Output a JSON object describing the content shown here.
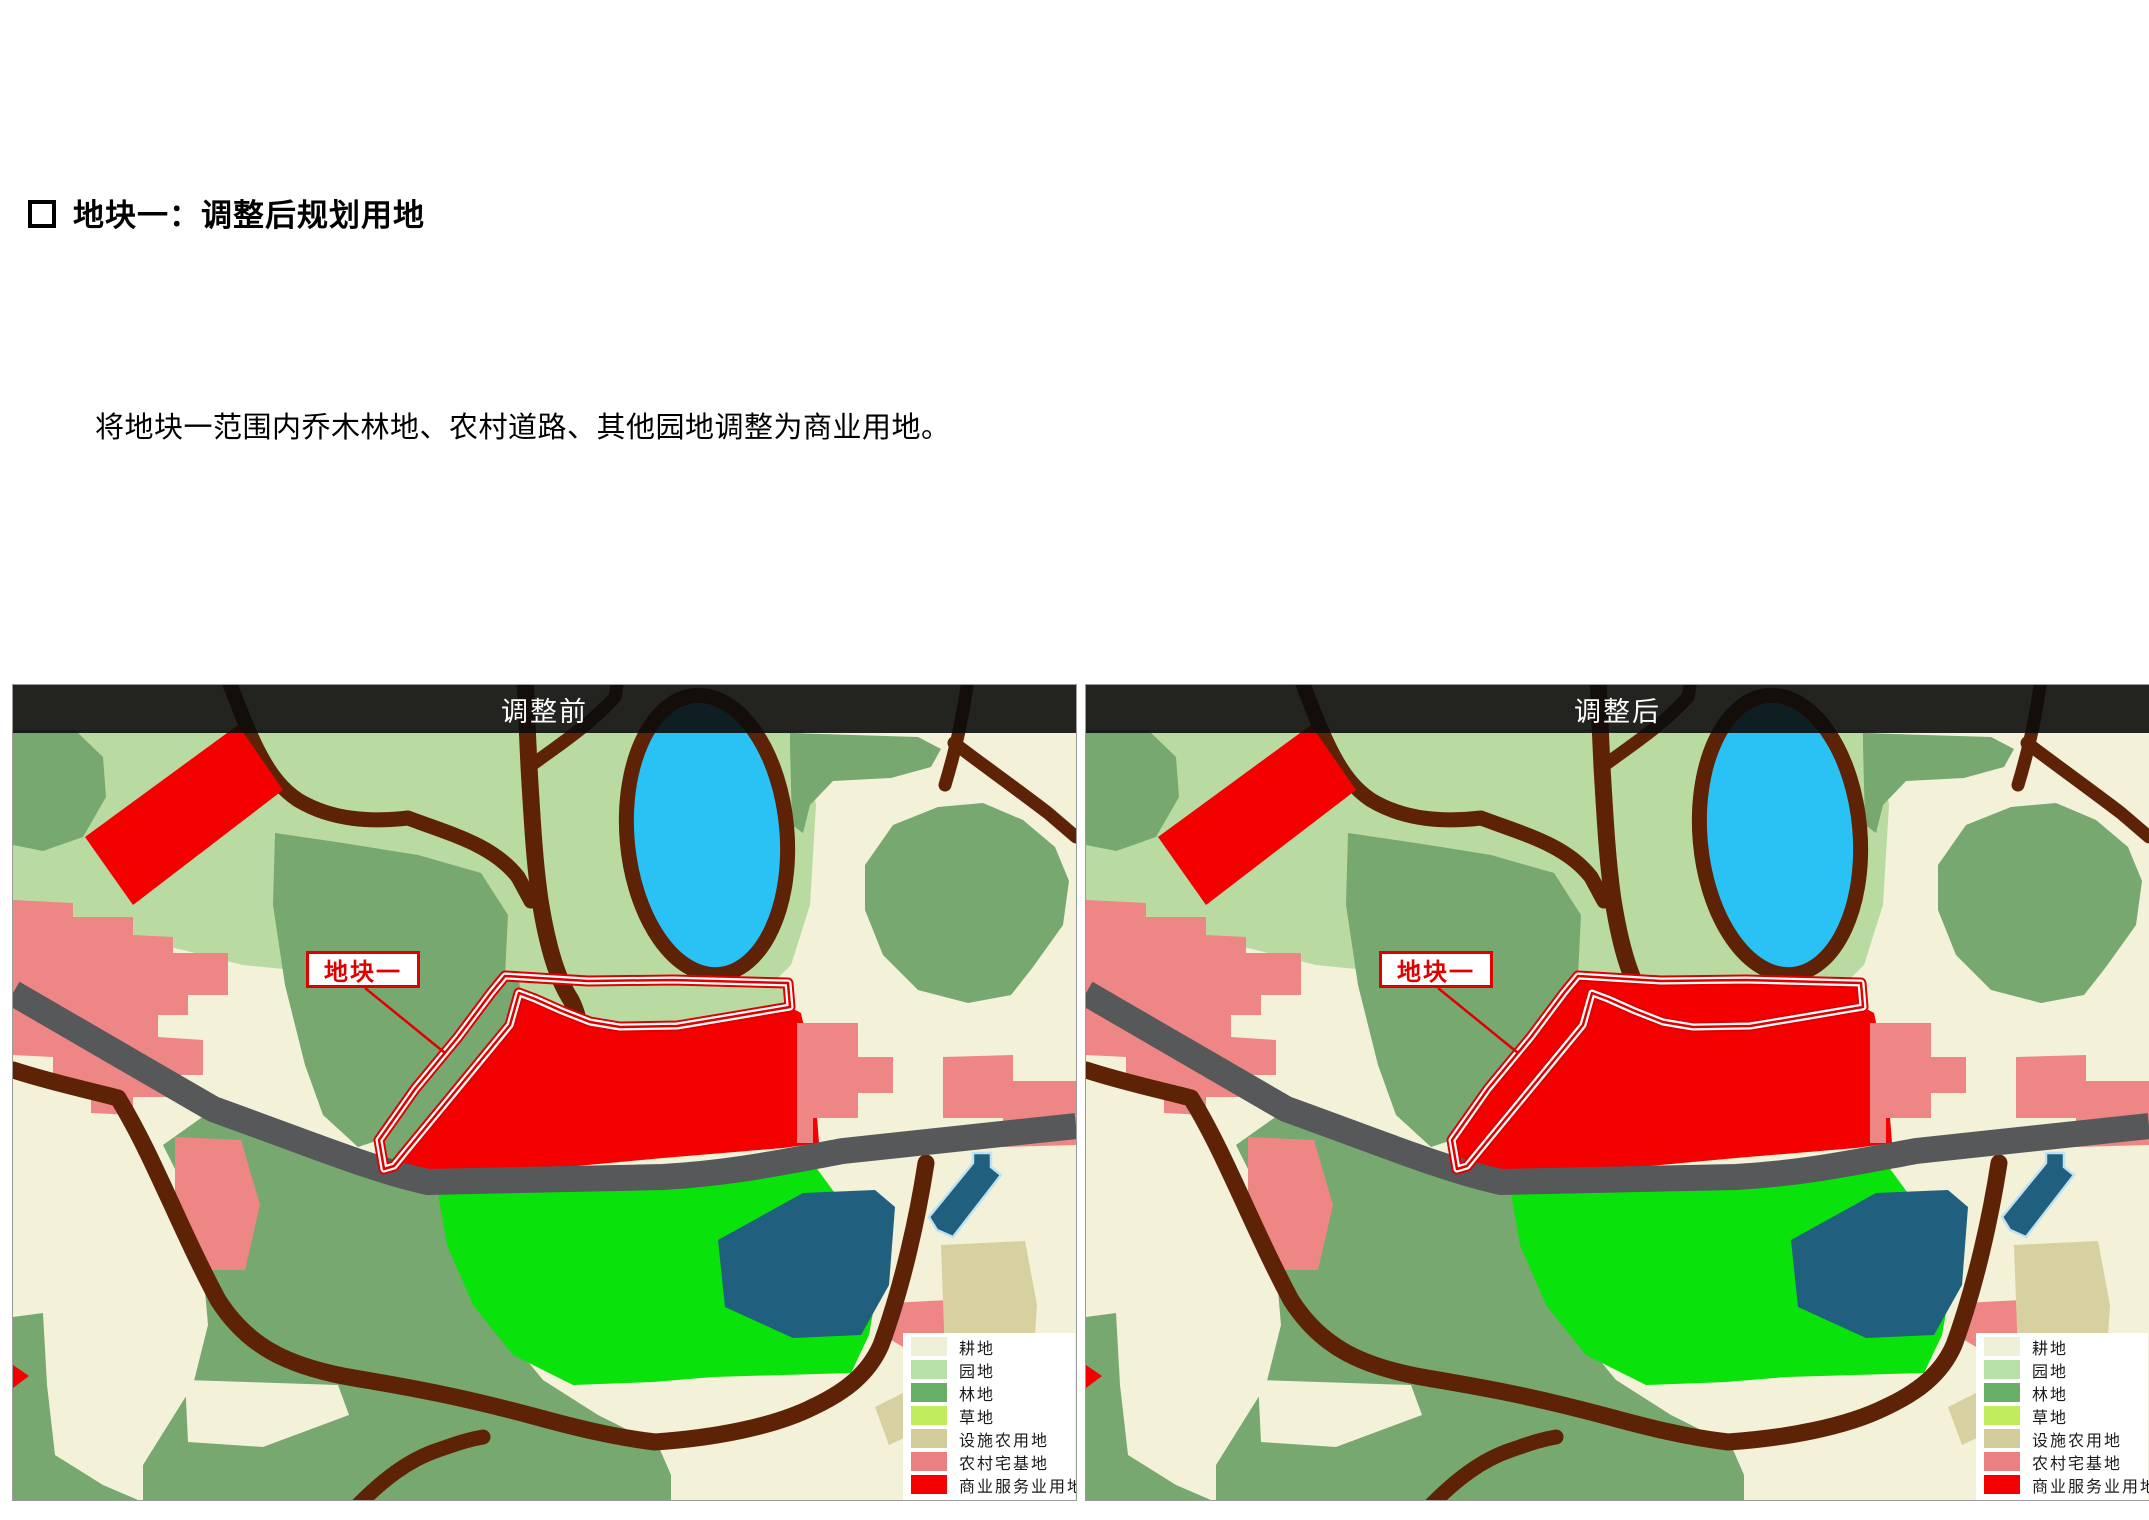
{
  "page": {
    "title": "地块一：调整后规划用地",
    "body": "将地块一范围内乔木林地、农村道路、其他园地调整为商业用地。"
  },
  "maps": [
    {
      "id": "before",
      "header": "调整前",
      "plot_label": "地块一",
      "variant": "before"
    },
    {
      "id": "after",
      "header": "调整后",
      "plot_label": "地块一",
      "variant": "after"
    }
  ],
  "legend": {
    "items": [
      {
        "label": "耕地",
        "color": "#f0efd8"
      },
      {
        "label": "园地",
        "color": "#b6e0a5"
      },
      {
        "label": "林地",
        "color": "#68ae67"
      },
      {
        "label": "草地",
        "color": "#c0ec5d"
      },
      {
        "label": "设施农用地",
        "color": "#d3cc9b"
      },
      {
        "label": "农村宅基地",
        "color": "#ea8180"
      },
      {
        "label": "商业服务业用地",
        "color": "#f40000"
      }
    ]
  },
  "palette": {
    "cream": "#f3f1d8",
    "garden": "#b9dba2",
    "forest": "#76a870",
    "bright_green": "#09e20b",
    "lake": "#2ac2f4",
    "pond": "#215f7e",
    "pond_border": "#bfe2f0",
    "road_brown": "#5e2306",
    "road_gray": "#57585a",
    "residential": "#ee8686",
    "commercial": "#f40000",
    "facility": "#d7d0a0",
    "outline_red": "#e00000",
    "white": "#ffffff"
  }
}
